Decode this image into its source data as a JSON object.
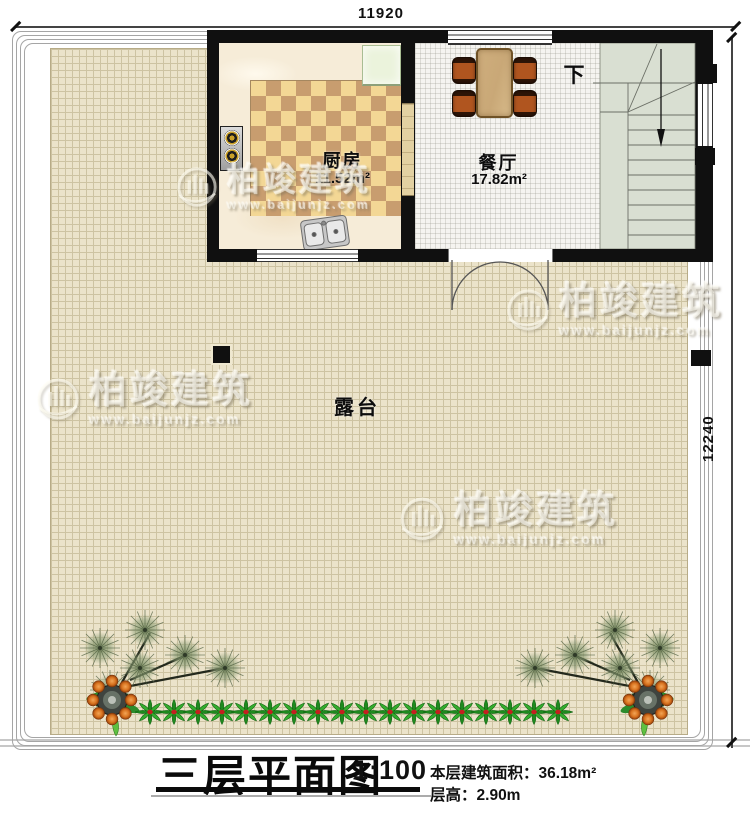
{
  "drawing": {
    "title": "三层平面图",
    "scale": "1:100",
    "stats": [
      {
        "label": "本层建筑面积：",
        "value": "36.18m²"
      },
      {
        "label": "层高：",
        "value": "2.90m"
      }
    ]
  },
  "dimensions": {
    "top_width": "11920",
    "right_height": "12240"
  },
  "rooms": {
    "kitchen": {
      "name": "厨房",
      "area": "11.52m²"
    },
    "dining": {
      "name": "餐厅",
      "area": "17.82m²"
    },
    "terrace": {
      "name": "露台"
    },
    "stairs": {
      "direction_label": "下"
    }
  },
  "watermark": {
    "brand": "柏竣建筑",
    "url": "www.baijunjz.com"
  },
  "colors": {
    "wall": "#101010",
    "checker_light": "#f3d795",
    "checker_dark": "#c89d6f",
    "marble": "#f6ecd8",
    "terrace_tile": "#ebe3ca",
    "terrace_line": "#cdc3a2",
    "dining_tile": "#f5f4f0",
    "stair_tread": "#d9dfd2",
    "table_wood": "#c9a877",
    "chair_orange": "#b0551f",
    "appliance_green": "#ebf3dc",
    "plant_green": "#1e8a1e",
    "fruit_orange": "#d9731f"
  }
}
